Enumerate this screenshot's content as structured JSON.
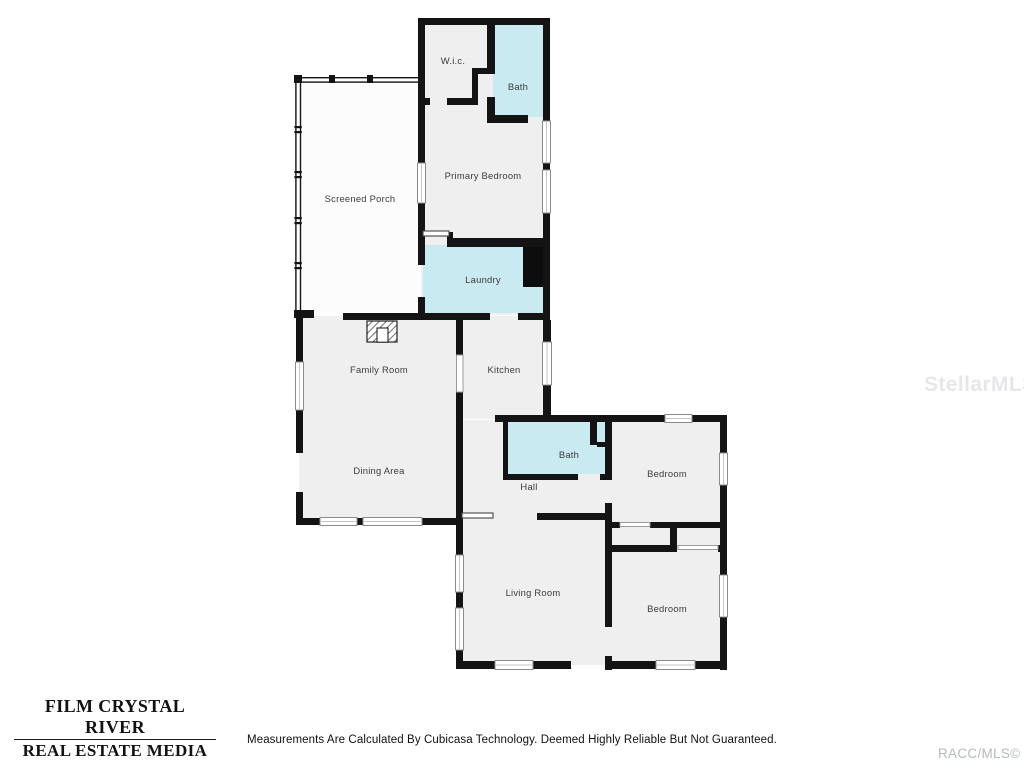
{
  "floorplan": {
    "colors": {
      "wall": "#141414",
      "room_fill": "#efefef",
      "wet_room_fill": "#c9eaf1"
    },
    "rooms": [
      {
        "key": "screened_porch",
        "label": "Screened Porch"
      },
      {
        "key": "wic",
        "label": "W.i.c."
      },
      {
        "key": "bath_top",
        "label": "Bath"
      },
      {
        "key": "primary_bedroom",
        "label": "Primary Bedroom"
      },
      {
        "key": "laundry",
        "label": "Laundry"
      },
      {
        "key": "family_room",
        "label": "Family Room"
      },
      {
        "key": "kitchen",
        "label": "Kitchen"
      },
      {
        "key": "dining_area",
        "label": "Dining Area"
      },
      {
        "key": "bath_hall",
        "label": "Bath"
      },
      {
        "key": "hall",
        "label": "Hall"
      },
      {
        "key": "bedroom_ne",
        "label": "Bedroom"
      },
      {
        "key": "living_room",
        "label": "Living Room"
      },
      {
        "key": "bedroom_se",
        "label": "Bedroom"
      }
    ]
  },
  "branding": {
    "line1": "FILM CRYSTAL RIVER",
    "line2": "REAL ESTATE MEDIA"
  },
  "footer": {
    "disclaimer": "Measurements Are Calculated By Cubicasa Technology. Deemed Highly Reliable But Not Guaranteed."
  },
  "watermarks": {
    "center": "StellarMLS",
    "bottom_right": "RACC/MLS©"
  }
}
